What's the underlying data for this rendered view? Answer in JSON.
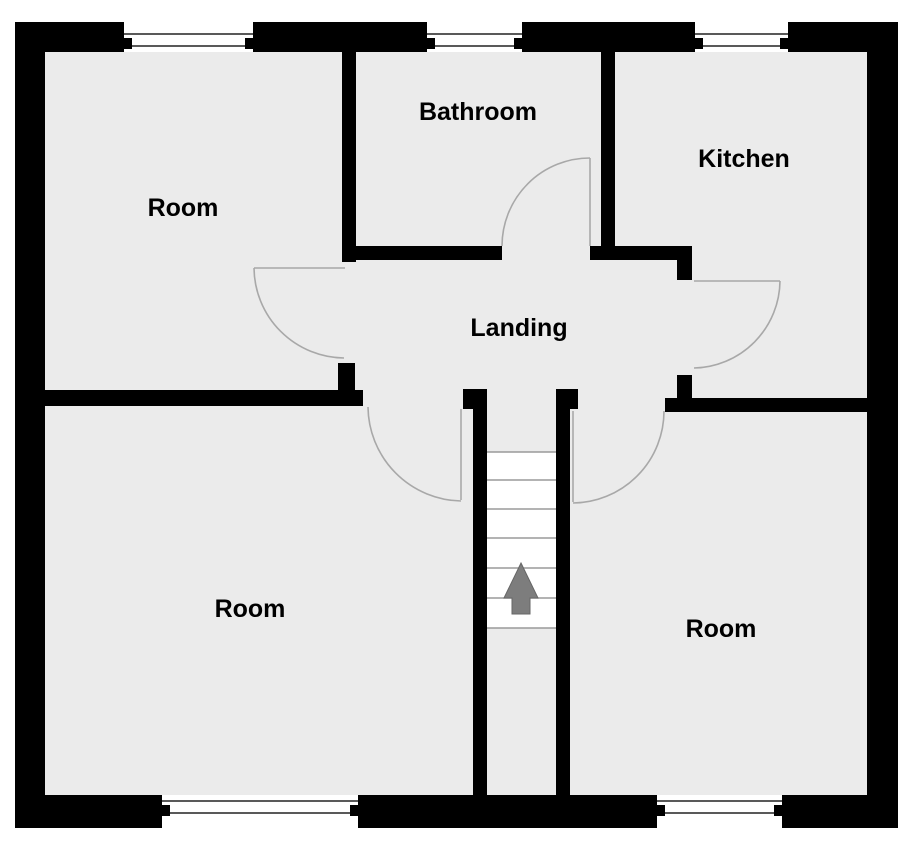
{
  "floorplan": {
    "canvas": {
      "w": 920,
      "h": 864
    },
    "colors": {
      "outside": "#ffffff",
      "floor": "#ebebeb",
      "wall": "#000000",
      "door_arc": "#a8a8a8",
      "window_line": "#222222",
      "stair_fill": "#ffffff",
      "stair_tread_line": "#9a9a9a",
      "arrow_fill": "#7d7d7d",
      "arrow_edge": "#666666",
      "label": "#000000"
    },
    "interior": {
      "x": 15,
      "y": 22,
      "w": 883,
      "h": 806
    },
    "labels": [
      {
        "id": "room-top-left",
        "text": "Room",
        "x": 183,
        "y": 208
      },
      {
        "id": "bathroom",
        "text": "Bathroom",
        "x": 478,
        "y": 112
      },
      {
        "id": "kitchen",
        "text": "Kitchen",
        "x": 744,
        "y": 159
      },
      {
        "id": "landing",
        "text": "Landing",
        "x": 519,
        "y": 328
      },
      {
        "id": "room-bottom-left",
        "text": "Room",
        "x": 250,
        "y": 609
      },
      {
        "id": "room-bottom-right",
        "text": "Room",
        "x": 721,
        "y": 629
      }
    ],
    "walls": [
      {
        "x": 15,
        "y": 22,
        "w": 109,
        "h": 30
      },
      {
        "x": 253,
        "y": 22,
        "w": 174,
        "h": 30
      },
      {
        "x": 522,
        "y": 22,
        "w": 173,
        "h": 30
      },
      {
        "x": 788,
        "y": 22,
        "w": 110,
        "h": 30
      },
      {
        "x": 15,
        "y": 22,
        "w": 30,
        "h": 806
      },
      {
        "x": 867,
        "y": 22,
        "w": 31,
        "h": 806
      },
      {
        "x": 15,
        "y": 795,
        "w": 147,
        "h": 33
      },
      {
        "x": 358,
        "y": 795,
        "w": 299,
        "h": 33
      },
      {
        "x": 782,
        "y": 795,
        "w": 116,
        "h": 33
      },
      {
        "x": 342,
        "y": 52,
        "w": 14,
        "h": 210
      },
      {
        "x": 601,
        "y": 52,
        "w": 14,
        "h": 208
      },
      {
        "x": 342,
        "y": 246,
        "w": 160,
        "h": 14
      },
      {
        "x": 590,
        "y": 246,
        "w": 25,
        "h": 14
      },
      {
        "x": 615,
        "y": 246,
        "w": 77,
        "h": 14
      },
      {
        "x": 677,
        "y": 260,
        "w": 15,
        "h": 20
      },
      {
        "x": 677,
        "y": 375,
        "w": 15,
        "h": 23
      },
      {
        "x": 665,
        "y": 398,
        "w": 202,
        "h": 14
      },
      {
        "x": 45,
        "y": 390,
        "w": 318,
        "h": 16
      },
      {
        "x": 338,
        "y": 363,
        "w": 17,
        "h": 27
      },
      {
        "x": 463,
        "y": 389,
        "w": 24,
        "h": 20
      },
      {
        "x": 473,
        "y": 390,
        "w": 14,
        "h": 405
      },
      {
        "x": 556,
        "y": 389,
        "w": 22,
        "h": 20
      },
      {
        "x": 556,
        "y": 390,
        "w": 14,
        "h": 405
      }
    ],
    "windows": [
      {
        "id": "window-room-top-left",
        "x": 124,
        "y": 22,
        "w": 129,
        "h": 30,
        "line1": 34,
        "line2": 46
      },
      {
        "id": "window-bathroom",
        "x": 427,
        "y": 22,
        "w": 95,
        "h": 30,
        "line1": 34,
        "line2": 46
      },
      {
        "id": "window-kitchen",
        "x": 695,
        "y": 22,
        "w": 93,
        "h": 30,
        "line1": 34,
        "line2": 46
      },
      {
        "id": "window-room-bottom-left",
        "x": 162,
        "y": 795,
        "w": 196,
        "h": 33,
        "line1": 801,
        "line2": 813
      },
      {
        "id": "window-room-bottom-right",
        "x": 657,
        "y": 795,
        "w": 125,
        "h": 33,
        "line1": 801,
        "line2": 813
      }
    ],
    "doors": [
      {
        "id": "door-room-top-left",
        "leaf": [
          345,
          268,
          254,
          268
        ],
        "arc": {
          "sx": 254,
          "sy": 268,
          "r": 91,
          "ex": 344,
          "ey": 358,
          "sweep": 0
        }
      },
      {
        "id": "door-bathroom",
        "leaf": [
          590,
          246,
          590,
          158
        ],
        "arc": {
          "sx": 502,
          "sy": 246,
          "r": 88,
          "ex": 590,
          "ey": 158,
          "sweep": 1
        }
      },
      {
        "id": "door-kitchen",
        "leaf": [
          694,
          281,
          780,
          281
        ],
        "arc": {
          "sx": 780,
          "sy": 281,
          "r": 88,
          "ex": 694,
          "ey": 368,
          "sweep": 1
        }
      },
      {
        "id": "door-room-bottom-left",
        "leaf": [
          461,
          409,
          461,
          500
        ],
        "arc": {
          "sx": 368,
          "sy": 407,
          "r": 95,
          "ex": 461,
          "ey": 501,
          "sweep": 0
        }
      },
      {
        "id": "door-room-bottom-right",
        "leaf": [
          573,
          411,
          573,
          502
        ],
        "arc": {
          "sx": 664,
          "sy": 411,
          "r": 92,
          "ex": 573,
          "ey": 503,
          "sweep": 1
        }
      }
    ],
    "stairs": {
      "well": {
        "x": 487,
        "y": 452,
        "w": 69,
        "h": 176
      },
      "tread_ys": [
        452,
        480,
        509,
        538,
        568,
        598,
        628
      ]
    },
    "arrow": {
      "direction": "up",
      "points": "521,563 538,598 530,598 530,614 512,614 512,598 504,598"
    }
  }
}
